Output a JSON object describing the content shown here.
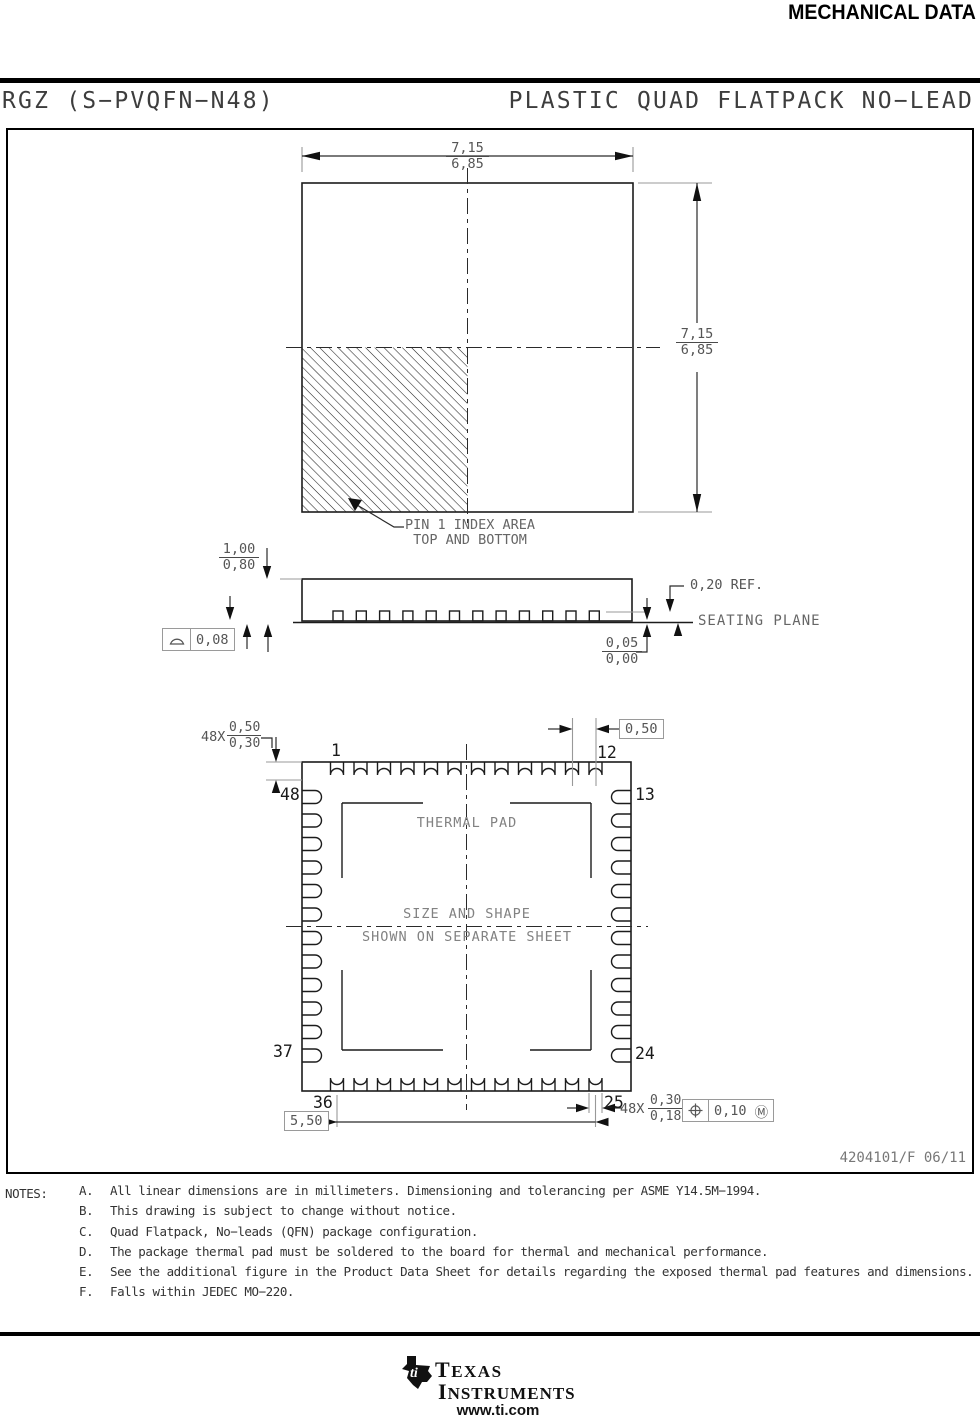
{
  "header": {
    "title": "MECHANICAL DATA"
  },
  "title_bar": {
    "left": "RGZ (S−PVQFN−N48)",
    "right": "PLASTIC QUAD FLATPACK NO−LEAD"
  },
  "top_view": {
    "dim_width": {
      "max": "7,15",
      "min": "6,85"
    },
    "dim_height": {
      "max": "7,15",
      "min": "6,85"
    },
    "pin1_note_line1": "PIN 1 INDEX AREA",
    "pin1_note_line2": "TOP AND BOTTOM"
  },
  "side_view": {
    "dim_height": {
      "max": "1,00",
      "min": "0,80"
    },
    "flatness_value": "0,08",
    "lead_ref": "0,20 REF.",
    "seating_plane": "SEATING PLANE",
    "standoff": {
      "max": "0,05",
      "min": "0,00"
    }
  },
  "bottom_view": {
    "pad_length": {
      "count": "48X",
      "max": "0,50",
      "min": "0,30"
    },
    "pitch": "0,50",
    "span": "5,50",
    "pad_width": {
      "count": "48X",
      "max": "0,30",
      "min": "0,18"
    },
    "position_tol": {
      "value": "0,10",
      "modifier": "Ⓜ"
    },
    "thermal_pad": "THERMAL PAD",
    "size_note_line1": "SIZE AND SHAPE",
    "size_note_line2": "SHOWN ON SEPARATE SHEET",
    "pins": {
      "p1": "1",
      "p12": "12",
      "p13": "13",
      "p24": "24",
      "p25": "25",
      "p36": "36",
      "p37": "37",
      "p48": "48"
    }
  },
  "doc_number": "4204101/F 06/11",
  "notes": {
    "label": "NOTES:",
    "items": [
      {
        "letter": "A.",
        "text": "All linear dimensions are in millimeters. Dimensioning and tolerancing per ASME Y14.5M−1994."
      },
      {
        "letter": "B.",
        "text": "This drawing is subject to change without notice."
      },
      {
        "letter": "C.",
        "text": "Quad Flatpack, No−leads (QFN) package configuration."
      },
      {
        "letter": "D.",
        "text": "The package thermal pad must be soldered to the board for thermal and mechanical performance."
      },
      {
        "letter": "E.",
        "text": "See the additional figure in the Product Data Sheet for details regarding the exposed thermal pad features and dimensions."
      },
      {
        "letter": "F.",
        "text": "Falls within JEDEC MO−220."
      }
    ]
  },
  "footer": {
    "brand_line1": "TEXAS",
    "brand_line2": "INSTRUMENTS",
    "url": "www.ti.com"
  },
  "colors": {
    "line": "#1c1c1c",
    "dim_text": "#555555",
    "accent": "#000000"
  }
}
